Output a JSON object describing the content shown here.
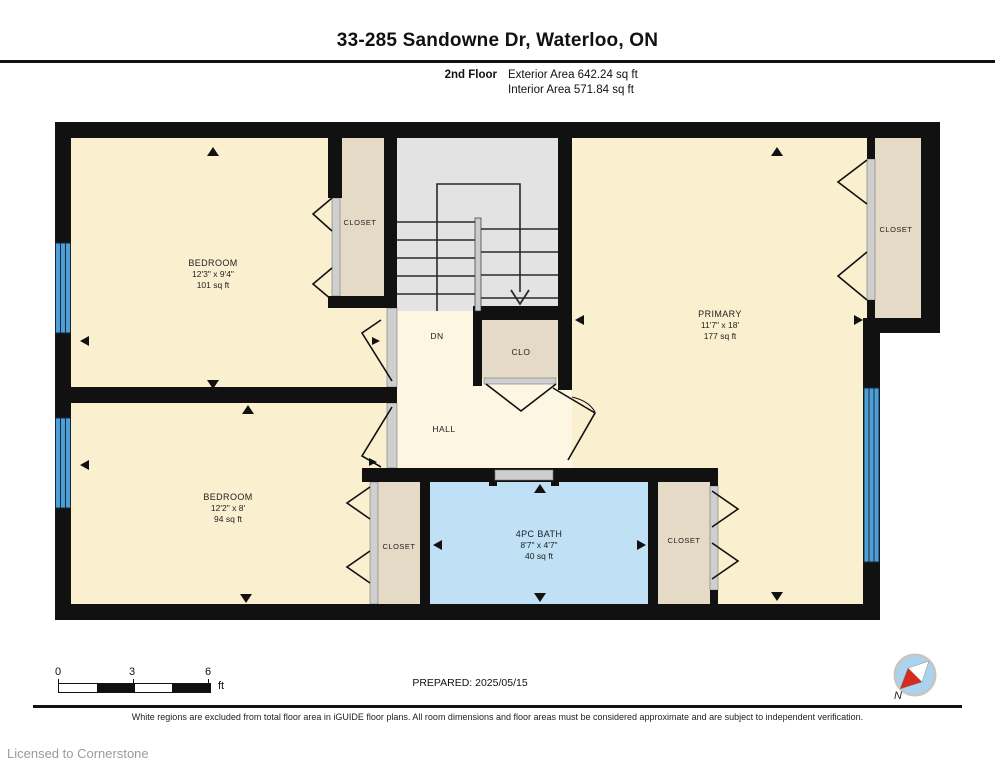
{
  "header": {
    "title": "33-285 Sandowne Dr, Waterloo, ON",
    "floor_label": "2nd Floor",
    "exterior_area": "Exterior Area 642.24 sq ft",
    "interior_area": "Interior Area 571.84 sq ft"
  },
  "rooms": {
    "bedroom_tl": {
      "name": "BEDROOM",
      "dims": "12'3\" x 9'4\"",
      "area": "101 sq ft"
    },
    "closet_tl": {
      "name": "CLOSET"
    },
    "stairs": {
      "down_label": "DN"
    },
    "clo": {
      "name": "CLO"
    },
    "hall": {
      "name": "HALL"
    },
    "primary": {
      "name": "PRIMARY",
      "dims": "11'7\" x 18'",
      "area": "177 sq ft"
    },
    "closet_tr": {
      "name": "CLOSET"
    },
    "bedroom_bl": {
      "name": "BEDROOM",
      "dims": "12'2\" x 8'",
      "area": "94 sq ft"
    },
    "closet_bl": {
      "name": "CLOSET"
    },
    "bath": {
      "name": "4PC BATH",
      "dims": "8'7\" x 4'7\"",
      "area": "40 sq ft"
    },
    "closet_br": {
      "name": "CLOSET"
    }
  },
  "scale_bar": {
    "tick0": "0",
    "tick3": "3",
    "tick6": "6",
    "unit": "ft"
  },
  "footer": {
    "prepared": "PREPARED: 2025/05/15",
    "disclaimer": "White regions are excluded from total floor area in iGUIDE floor plans. All room dimensions and floor areas must be considered approximate and are subject to independent verification.",
    "license": "Licensed to Cornerstone",
    "compass_label": "N"
  },
  "colors": {
    "wall": "#111111",
    "room_fill": "#FAEFCF",
    "hall_fill": "#FCF6E2",
    "closet_fill": "#E4DAC6",
    "stairs_fill": "#E3E3E3",
    "bath_fill": "#BFE0F5",
    "window_blue": "#4D9FD6",
    "compass_face": "#A9D4EF",
    "needle_red": "#D42B1E"
  }
}
